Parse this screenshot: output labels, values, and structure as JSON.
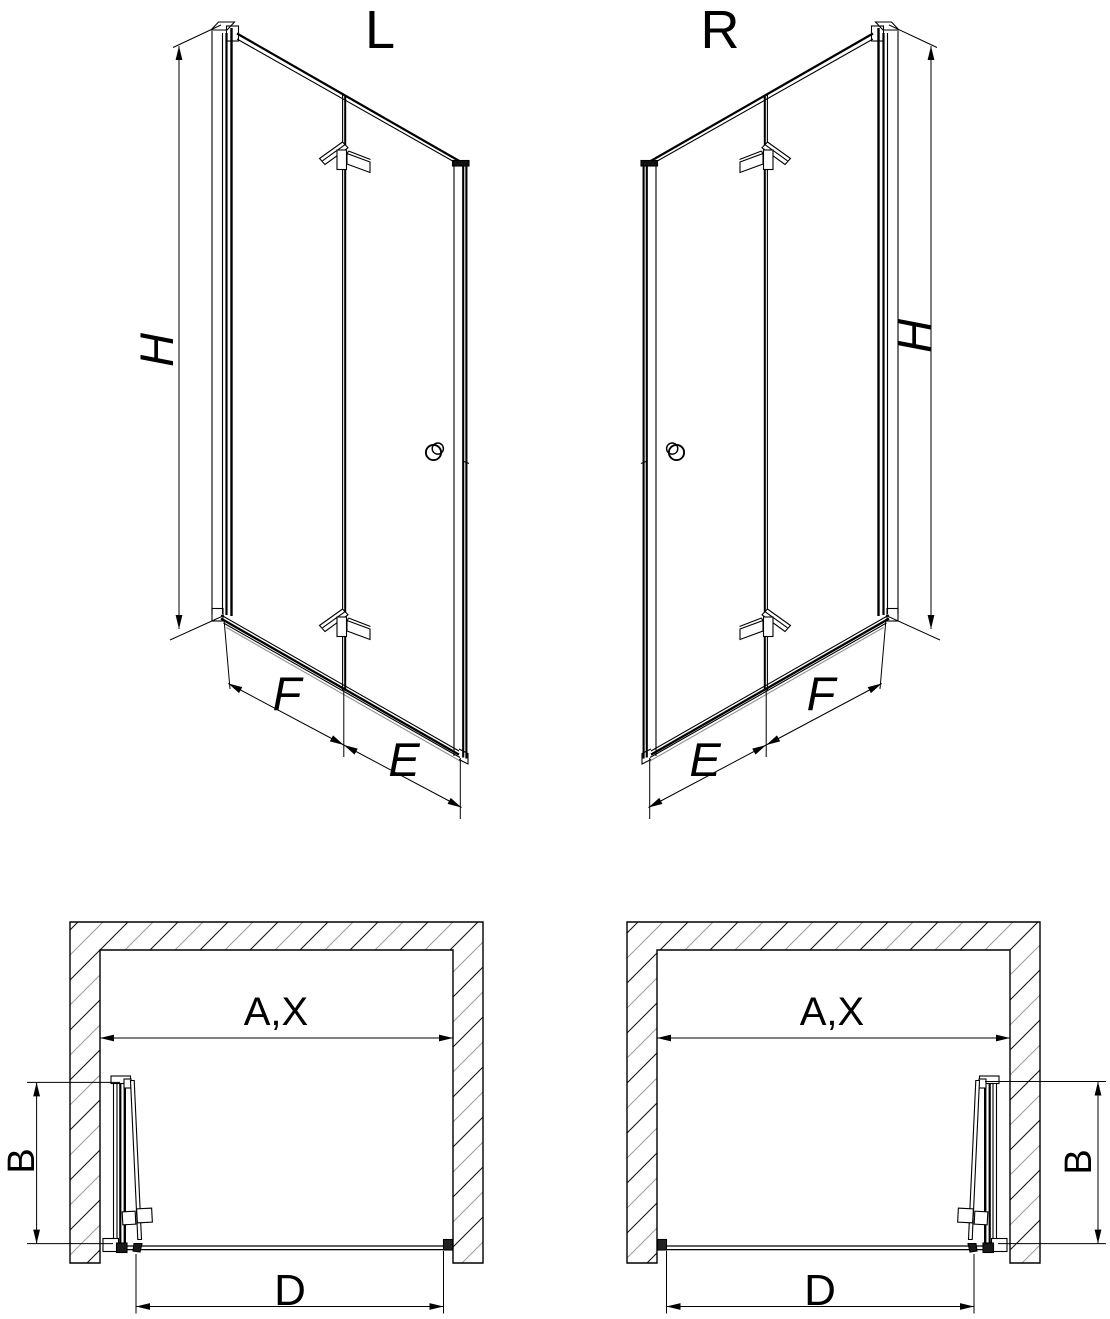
{
  "labels": {
    "persp_left": {
      "variant": "L",
      "height": "H",
      "panel_fold": "F",
      "panel_return": "E"
    },
    "persp_right": {
      "variant": "R",
      "height": "H",
      "panel_fold": "F",
      "panel_return": "E"
    },
    "plan_left": {
      "opening": "A,X",
      "depth": "B",
      "entry": "D"
    },
    "plan_right": {
      "opening": "A,X",
      "depth": "B",
      "entry": "D"
    }
  },
  "colors": {
    "line": "#000000",
    "secondary_line": "#8f8f8f",
    "background": "#ffffff"
  }
}
